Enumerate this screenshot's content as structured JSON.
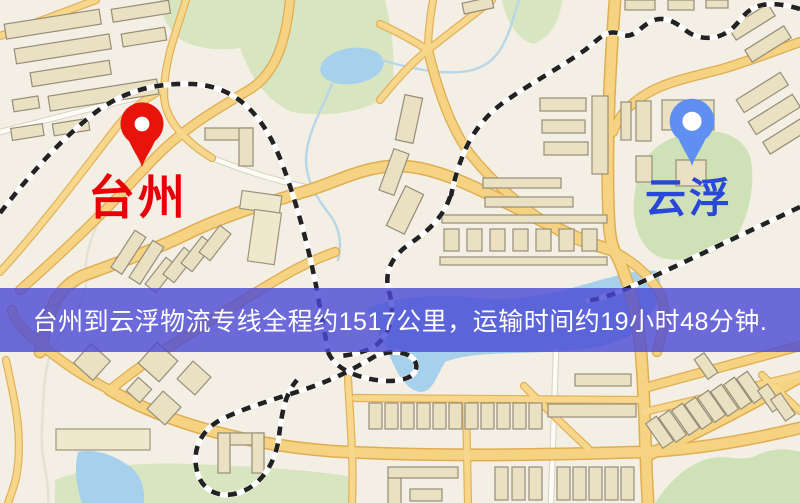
{
  "map": {
    "origin_marker": {
      "label": "台州",
      "marker_color": "#e8130a",
      "label_color": "#e60108",
      "icon": "location-pin-icon"
    },
    "destination_marker": {
      "label": "云浮",
      "marker_color": "#5f8ff0",
      "label_color": "#2948d8",
      "icon": "location-pin-icon"
    },
    "banner": {
      "text": "台州到云浮物流专线全程约1517公里，运输时间约19小时48分钟.",
      "background_color": "#4a48d6",
      "text_color": "#ffffff"
    },
    "route": {
      "distance_text": "约1517公里",
      "duration_text": "约19小时48分钟"
    }
  }
}
